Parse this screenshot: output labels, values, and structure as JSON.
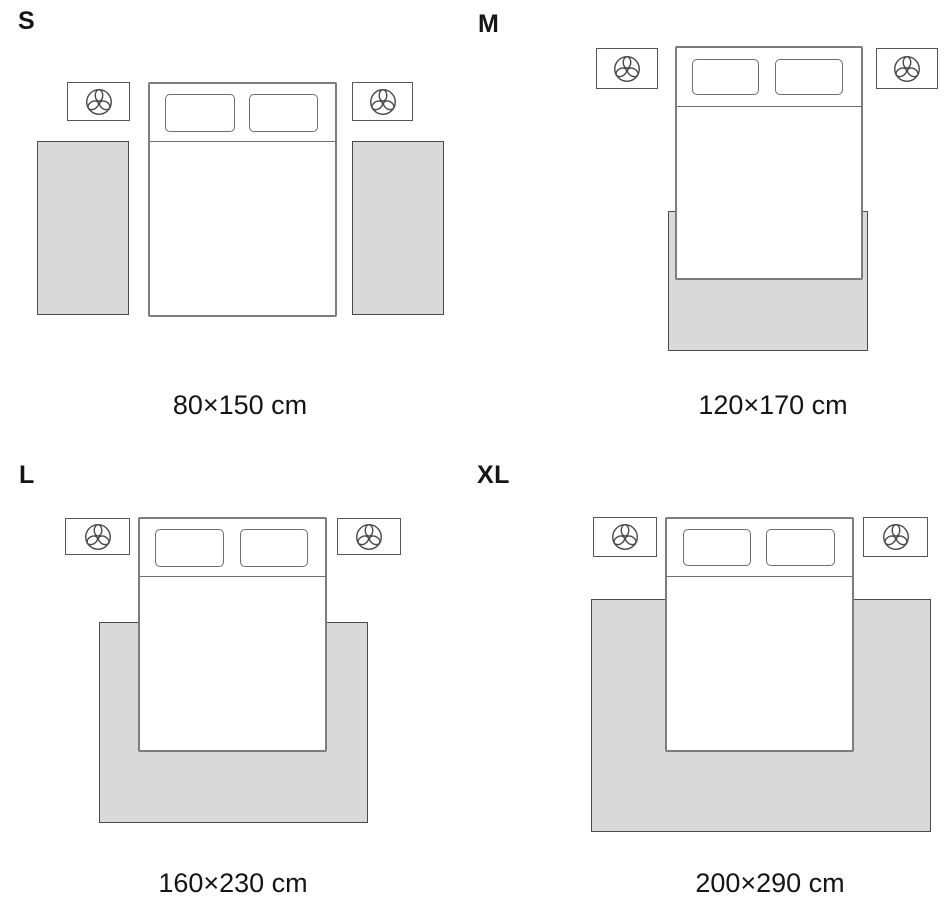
{
  "colors": {
    "text": "#151515",
    "rug_fill": "#d9d9d9",
    "rug_border": "#4c4c4c",
    "bed_border": "#7d7d7d",
    "nightstand_border": "#565656"
  },
  "icons": {
    "nightstand_decor": "plant-icon"
  },
  "sizes": [
    {
      "label": "S",
      "dimensions": "80×150 cm"
    },
    {
      "label": "M",
      "dimensions": "120×170 cm"
    },
    {
      "label": "L",
      "dimensions": "160×230 cm"
    },
    {
      "label": "XL",
      "dimensions": "200×290 cm"
    }
  ]
}
